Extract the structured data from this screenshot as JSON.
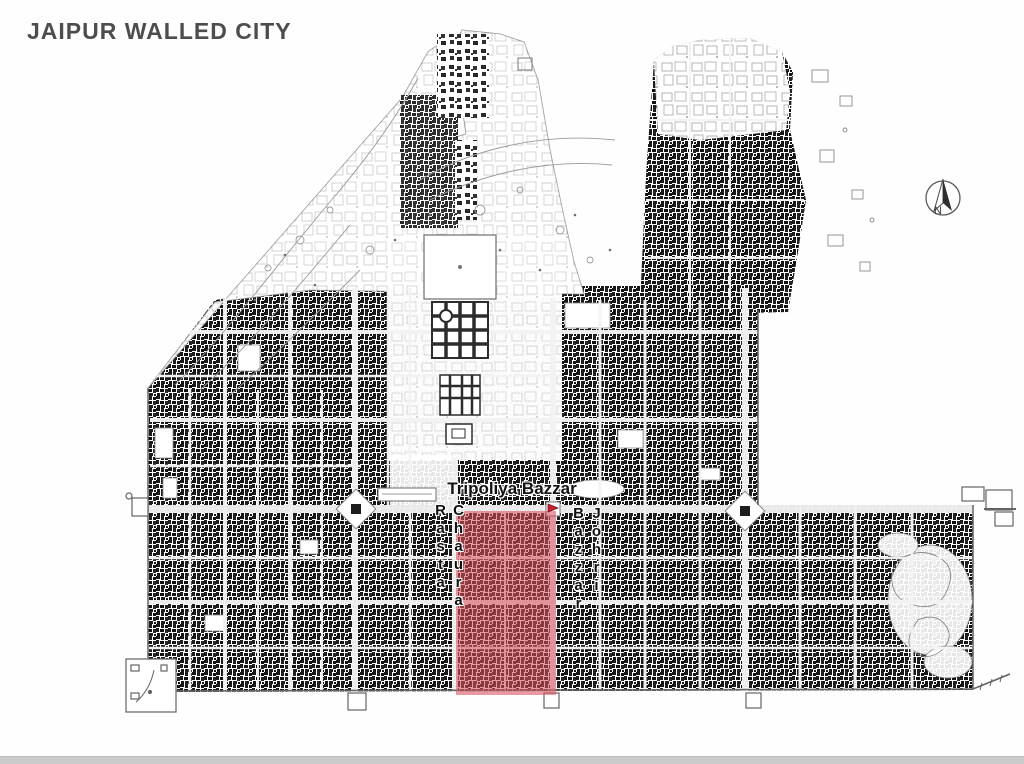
{
  "title": "JAIPUR WALLED CITY",
  "colors": {
    "highlight": "#d9505c",
    "ink": "#111111",
    "title": "#4d4d4d"
  },
  "map": {
    "labels": {
      "main_bazaar": "Tripoliya Bazzar",
      "street_left": "Chaura Rasta",
      "street_right": "Johri Bazzar"
    },
    "north_arrow_letter": "N"
  }
}
